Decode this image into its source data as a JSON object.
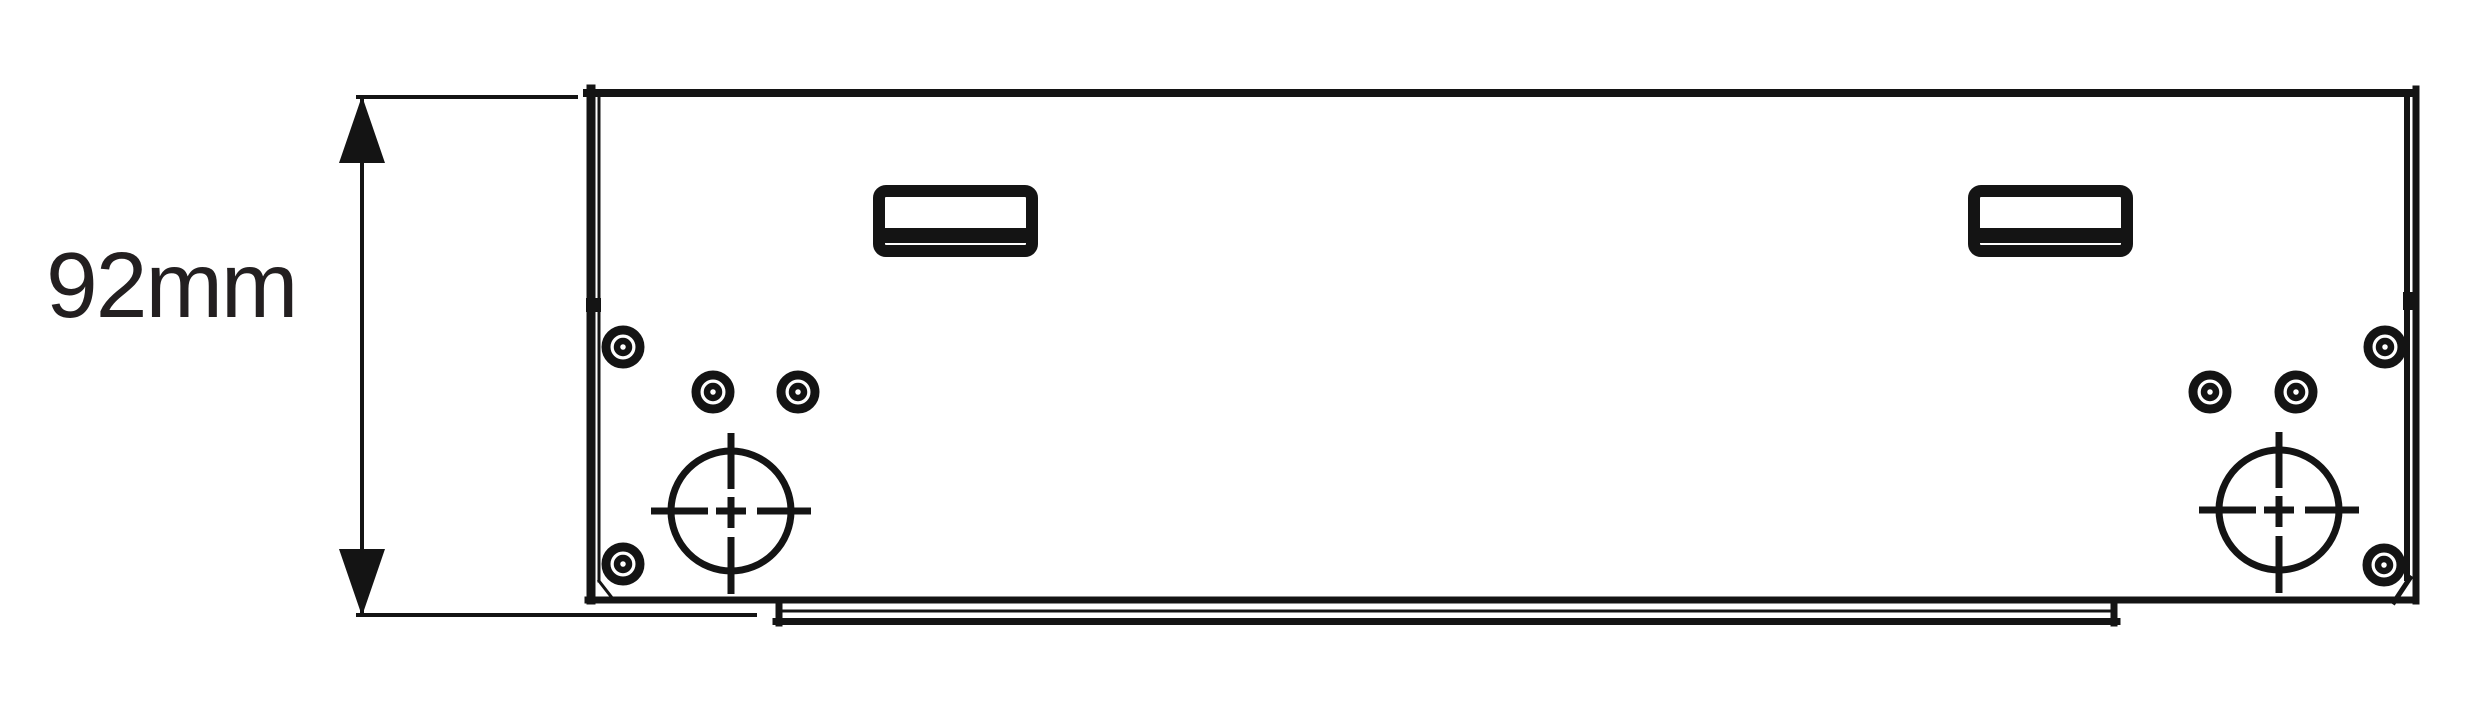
{
  "drawing": {
    "type": "technical-dimension-drawing",
    "background": "#ffffff",
    "line_color": "#141414",
    "text_color": "#231f20",
    "dimension": {
      "label": "92mm"
    }
  }
}
